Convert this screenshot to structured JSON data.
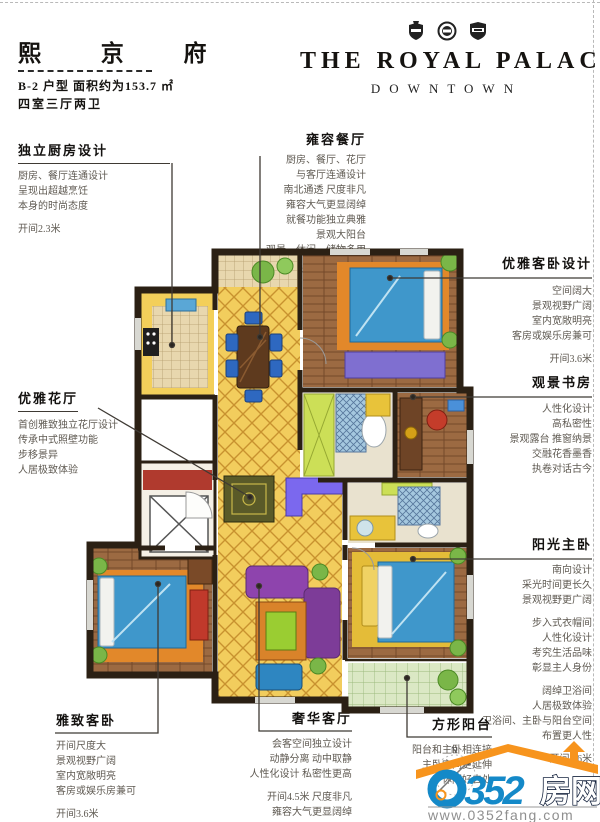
{
  "header": {
    "title": "熙 京 府",
    "subtitle1": "B-2 户型  面积约为153.7 ㎡",
    "subtitle2": "四室三厅两卫",
    "brand_name": "THE ROYAL PALACE",
    "brand_tagline": "DOWNTOWN"
  },
  "annotations": {
    "kitchen": {
      "title": "独立厨房设计",
      "lines": [
        "厨房、餐厅连通设计",
        "呈现出超越烹饪",
        "本身的时尚态度"
      ],
      "metric": "开间2.3米"
    },
    "dining": {
      "title": "雍容餐厅",
      "lines": [
        "厨房、餐厅、花厅",
        "与客厅连通设计",
        "南北通透 尺度非凡",
        "雍容大气更显阔绰",
        "就餐功能独立典雅",
        "景观大阳台",
        "观景、休闲、储物多用"
      ],
      "metric": "开间3米  进深4米"
    },
    "guest_bedroom_top": {
      "title": "优雅客卧设计",
      "lines": [
        "空间阔大",
        "景观视野广阔",
        "室内宽敞明亮",
        "客房或娱乐房兼可"
      ],
      "metric": "开间3.6米"
    },
    "study": {
      "title": "观景书房",
      "lines": [
        "人性化设计",
        "高私密性",
        "景观露台 推窗纳景",
        "交融花香墨香",
        "执卷对话古今"
      ]
    },
    "master_bedroom": {
      "title": "阳光主卧",
      "lines1": [
        "南向设计",
        "采光时间更长久",
        "景观视野更广阔"
      ],
      "lines2": [
        "步入式衣帽间",
        "人性化设计",
        "考究生活品味",
        "彰显主人身份"
      ],
      "lines3": [
        "阔绰卫浴间",
        "人居极致体验",
        "卫浴间、主卧与阳台空间",
        "布置更人性"
      ],
      "metric": "开间3.6米"
    },
    "flower_hall": {
      "title": "优雅花厅",
      "lines": [
        "首创雅致独立花厅设计",
        "传承中式照壁功能",
        "步移景异",
        "人居极致体验"
      ]
    },
    "guest_bedroom_bottom": {
      "title": "雅致客卧",
      "lines": [
        "开间尺度大",
        "景观视野广阔",
        "室内宽敞明亮",
        "客房或娱乐房兼可"
      ],
      "metric": "开间3.6米"
    },
    "living_room": {
      "title": "奢华客厅",
      "lines": [
        "会客空间独立设计",
        "动静分离 动中取静",
        "人性化设计 私密性更高"
      ],
      "metric1": "开间4.5米  尺度非凡",
      "metric2": "雍容大气更显阔绰"
    },
    "square_balcony": {
      "title": "方形阳台",
      "lines": [
        "阳台和主卧相连接",
        "主卧空间更延伸",
        "休闲好去处"
      ]
    }
  },
  "footer_logo": {
    "number_rest": "352",
    "site_cn": "房网",
    "url": "www.0352fang.com",
    "compass_label": "N"
  },
  "palette": {
    "wall": "#2b2014",
    "floor_yellow": "#f0c84a",
    "wood": "#9c6a42",
    "bed_blue": "#3f97cb",
    "rug_orange": "#e2882a",
    "plant_green": "#7ab648",
    "sofa_purple": "#8e44ad",
    "logo_blue": "#1489c8",
    "logo_orange": "#f7941d",
    "url_gray": "#8f8f8f"
  }
}
